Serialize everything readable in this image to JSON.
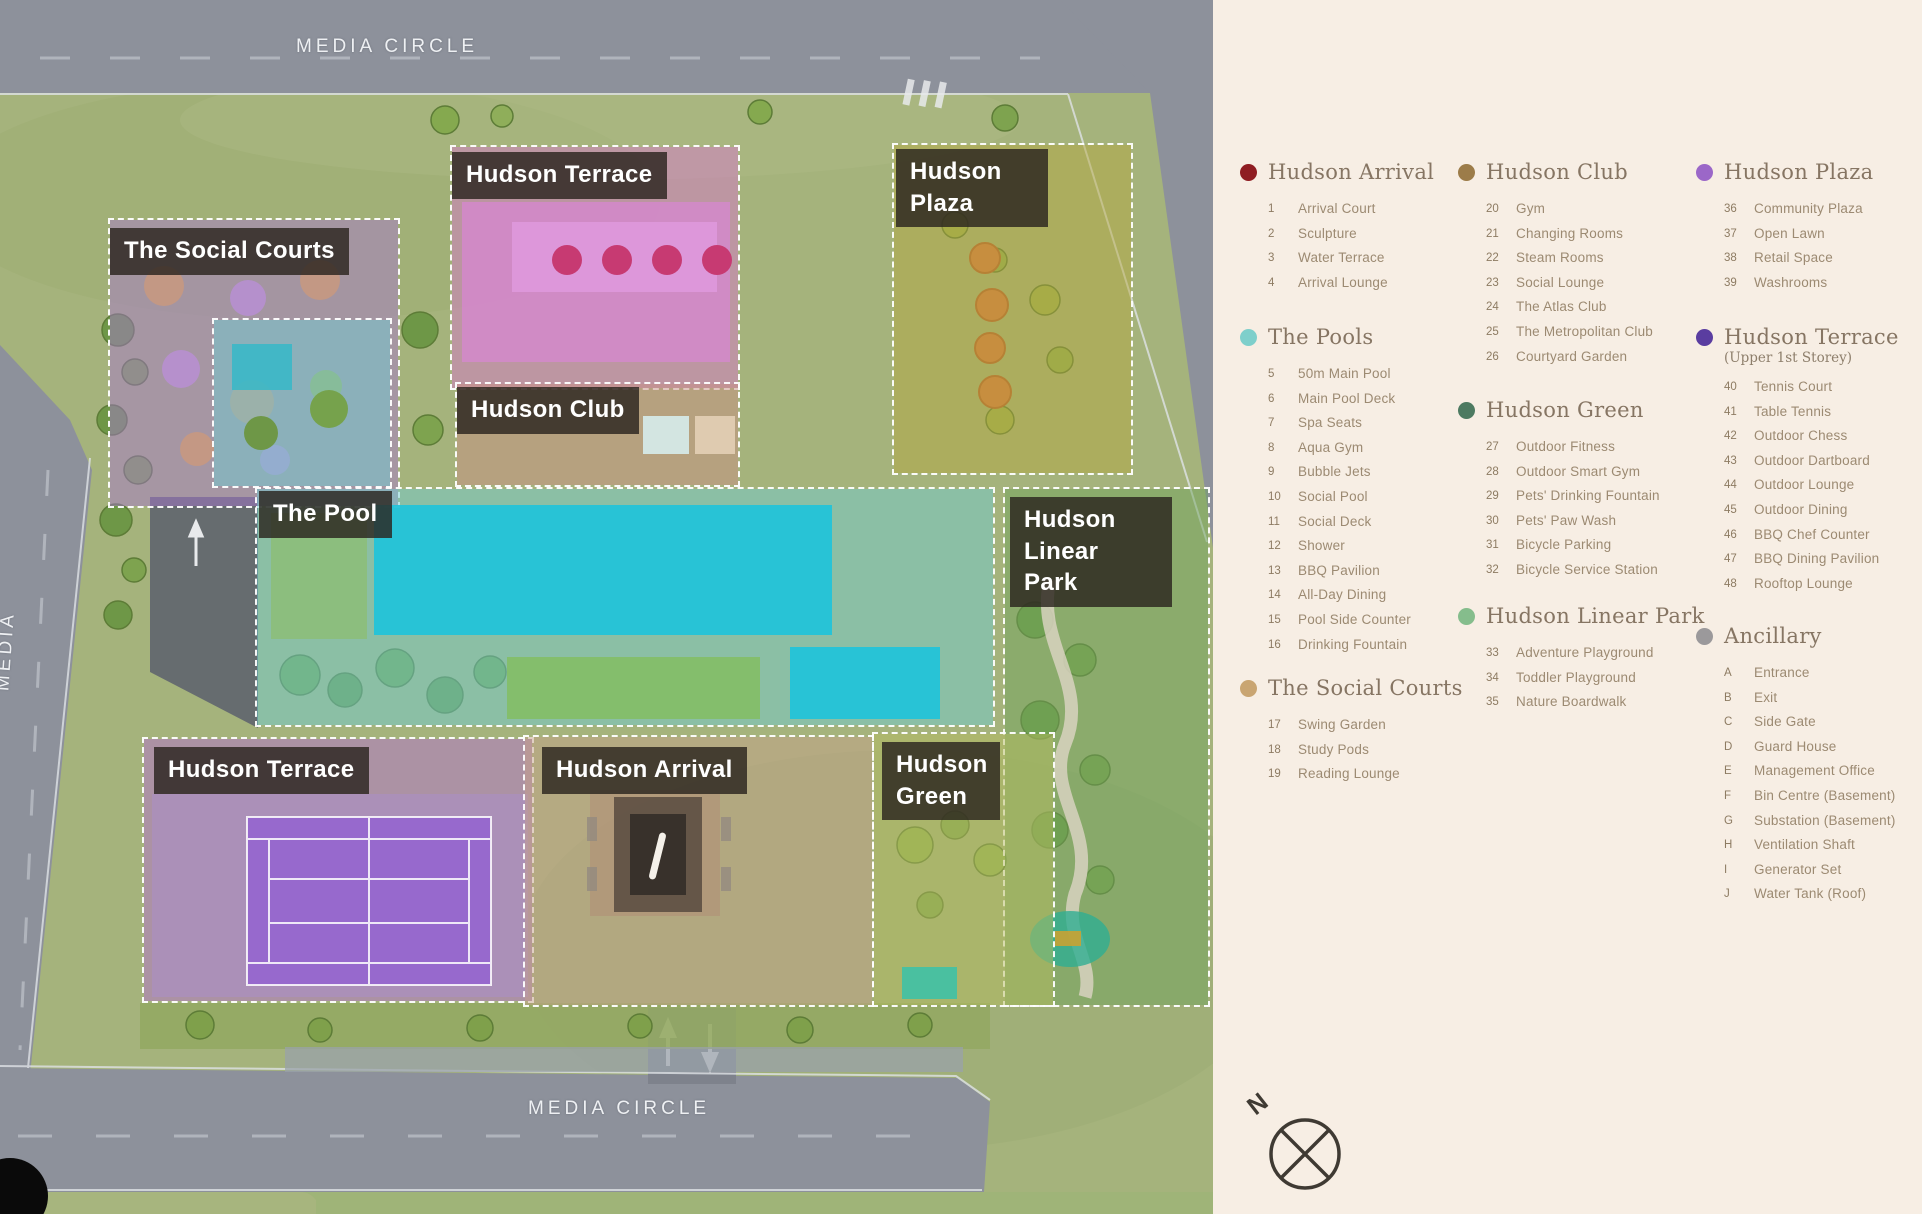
{
  "map": {
    "road_labels": {
      "top": "MEDIA  CIRCLE",
      "bottom": "MEDIA  CIRCLE",
      "left": "MEDIA"
    },
    "compass_north_label": "N",
    "zones": [
      {
        "id": "the-social-courts",
        "label": "The Social Courts",
        "color": "#a878cf"
      },
      {
        "id": "hudson-terrace-upper",
        "label": "Hudson Terrace",
        "color": "#d878cc"
      },
      {
        "id": "hudson-plaza",
        "label": "Hudson Plaza",
        "color": "#b4a83f"
      },
      {
        "id": "hudson-club",
        "label": "Hudson Club",
        "color": "#c98e84"
      },
      {
        "id": "the-pool",
        "label": "The Pool",
        "color": "#6fcdd4"
      },
      {
        "id": "hudson-linear-park",
        "label": "Hudson Linear Park",
        "color": "#6fa35c"
      },
      {
        "id": "hudson-terrace-lower",
        "label": "Hudson Terrace",
        "color": "#b46fd0"
      },
      {
        "id": "hudson-arrival",
        "label": "Hudson Arrival",
        "color": "#c7a089"
      },
      {
        "id": "hudson-green",
        "label": "Hudson Green",
        "color": "#b6bd5e"
      }
    ]
  },
  "legend": {
    "background": "#f7eee4",
    "sections": [
      {
        "title": "Hudson Arrival",
        "dot_color": "#8f1d22",
        "items": [
          {
            "num": "1",
            "label": "Arrival Court"
          },
          {
            "num": "2",
            "label": "Sculpture"
          },
          {
            "num": "3",
            "label": "Water Terrace"
          },
          {
            "num": "4",
            "label": "Arrival Lounge"
          }
        ]
      },
      {
        "title": "The Pools",
        "dot_color": "#7ecfcb",
        "items": [
          {
            "num": "5",
            "label": "50m Main Pool"
          },
          {
            "num": "6",
            "label": "Main Pool Deck"
          },
          {
            "num": "7",
            "label": "Spa Seats"
          },
          {
            "num": "8",
            "label": "Aqua Gym"
          },
          {
            "num": "9",
            "label": "Bubble Jets"
          },
          {
            "num": "10",
            "label": "Social Pool"
          },
          {
            "num": "11",
            "label": "Social Deck"
          },
          {
            "num": "12",
            "label": "Shower"
          },
          {
            "num": "13",
            "label": "BBQ Pavilion"
          },
          {
            "num": "14",
            "label": "All-Day Dining"
          },
          {
            "num": "15",
            "label": "Pool Side Counter"
          },
          {
            "num": "16",
            "label": "Drinking Fountain"
          }
        ]
      },
      {
        "title": "The Social Courts",
        "dot_color": "#c9a572",
        "items": [
          {
            "num": "17",
            "label": "Swing Garden"
          },
          {
            "num": "18",
            "label": "Study Pods"
          },
          {
            "num": "19",
            "label": "Reading Lounge"
          }
        ]
      },
      {
        "title": "Hudson Club",
        "dot_color": "#9c7c49",
        "items": [
          {
            "num": "20",
            "label": "Gym"
          },
          {
            "num": "21",
            "label": "Changing Rooms"
          },
          {
            "num": "22",
            "label": "Steam Rooms"
          },
          {
            "num": "23",
            "label": "Social Lounge"
          },
          {
            "num": "24",
            "label": "The Atlas Club"
          },
          {
            "num": "25",
            "label": "The Metropolitan Club"
          },
          {
            "num": "26",
            "label": "Courtyard Garden"
          }
        ]
      },
      {
        "title": "Hudson Green",
        "dot_color": "#4d7a61",
        "items": [
          {
            "num": "27",
            "label": "Outdoor Fitness"
          },
          {
            "num": "28",
            "label": "Outdoor Smart Gym"
          },
          {
            "num": "29",
            "label": "Pets' Drinking Fountain"
          },
          {
            "num": "30",
            "label": "Pets' Paw Wash"
          },
          {
            "num": "31",
            "label": "Bicycle Parking"
          },
          {
            "num": "32",
            "label": "Bicycle Service Station"
          }
        ]
      },
      {
        "title": "Hudson Linear Park",
        "dot_color": "#85bd8c",
        "items": [
          {
            "num": "33",
            "label": "Adventure Playground"
          },
          {
            "num": "34",
            "label": "Toddler Playground"
          },
          {
            "num": "35",
            "label": "Nature Boardwalk"
          }
        ]
      },
      {
        "title": "Hudson Plaza",
        "dot_color": "#9b67c8",
        "items": [
          {
            "num": "36",
            "label": "Community Plaza"
          },
          {
            "num": "37",
            "label": "Open Lawn"
          },
          {
            "num": "38",
            "label": "Retail Space"
          },
          {
            "num": "39",
            "label": "Washrooms"
          }
        ]
      },
      {
        "title": "Hudson Terrace",
        "subtitle": "(Upper 1st Storey)",
        "dot_color": "#5a3da0",
        "items": [
          {
            "num": "40",
            "label": "Tennis Court"
          },
          {
            "num": "41",
            "label": "Table Tennis"
          },
          {
            "num": "42",
            "label": "Outdoor Chess"
          },
          {
            "num": "43",
            "label": "Outdoor Dartboard"
          },
          {
            "num": "44",
            "label": "Outdoor Lounge"
          },
          {
            "num": "45",
            "label": "Outdoor Dining"
          },
          {
            "num": "46",
            "label": "BBQ Chef Counter"
          },
          {
            "num": "47",
            "label": "BBQ Dining Pavilion"
          },
          {
            "num": "48",
            "label": "Rooftop Lounge"
          }
        ]
      },
      {
        "title": "Ancillary",
        "dot_color": "#9b999b",
        "items": [
          {
            "num": "A",
            "label": "Entrance"
          },
          {
            "num": "B",
            "label": "Exit"
          },
          {
            "num": "C",
            "label": "Side Gate"
          },
          {
            "num": "D",
            "label": "Guard House"
          },
          {
            "num": "E",
            "label": "Management Office"
          },
          {
            "num": "F",
            "label": "Bin Centre (Basement)"
          },
          {
            "num": "G",
            "label": "Substation (Basement)"
          },
          {
            "num": "H",
            "label": "Ventilation Shaft"
          },
          {
            "num": "I",
            "label": "Generator Set"
          },
          {
            "num": "J",
            "label": "Water Tank (Roof)"
          }
        ]
      }
    ]
  }
}
